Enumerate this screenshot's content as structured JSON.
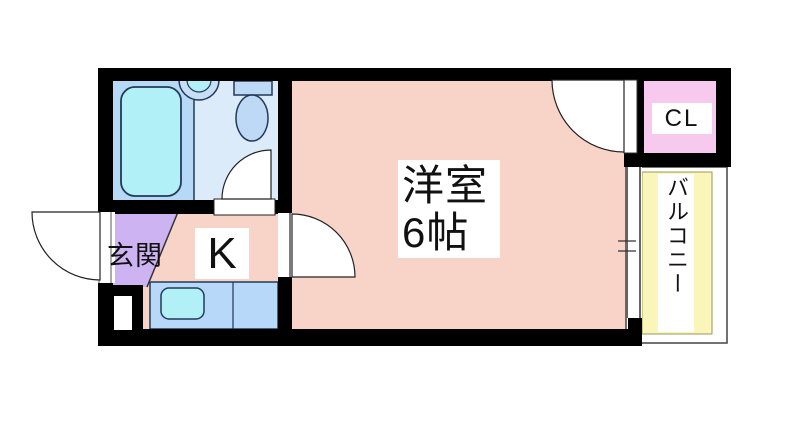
{
  "rooms": {
    "entrance": {
      "label": "玄関"
    },
    "kitchen": {
      "label": "K"
    },
    "main_room": {
      "label": "洋室",
      "size": "6帖"
    },
    "closet": {
      "label": "CL"
    },
    "balcony": {
      "label": "バルコニー"
    }
  },
  "colors": {
    "wall": "#000000",
    "room_pink": "#f8d3c8",
    "entrance_purple": "#cdb3f1",
    "closet_pink": "#f7c9ef",
    "balcony_yellow": "#faf5b8",
    "bath_left_blue": "#b5d9f7",
    "bath_right_blue": "#dcebfa",
    "fixture_blue": "#bdd9f6",
    "counter_blue": "#b7d8f8",
    "water_cyan": "#b2f0f8",
    "fixture_outline": "#223a55"
  }
}
